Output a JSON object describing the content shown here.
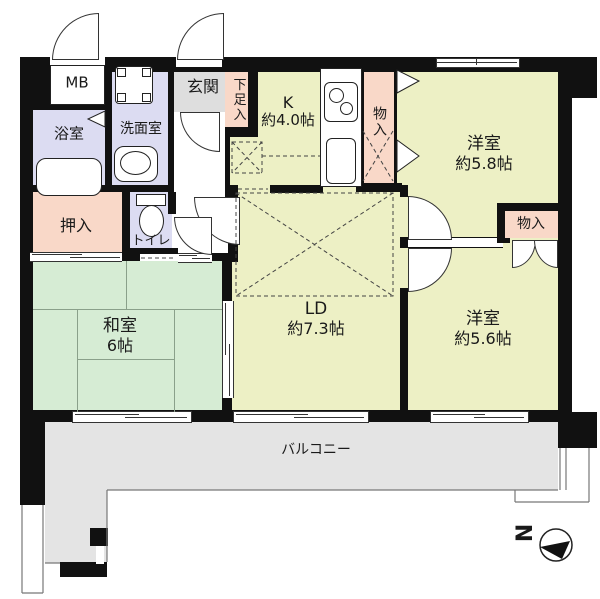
{
  "rooms": {
    "mb": {
      "label": "MB"
    },
    "bathroom": {
      "label": "浴室"
    },
    "washroom": {
      "label": "洗面室"
    },
    "entrance": {
      "label": "玄関"
    },
    "shoe_storage": {
      "label": "下足入"
    },
    "kitchen": {
      "label": "K",
      "size": "約4.0帖"
    },
    "storage_top": {
      "label": "物入"
    },
    "western_room_1": {
      "label": "洋室",
      "size": "約5.8帖"
    },
    "closet_oshiire": {
      "label": "押入"
    },
    "toilet": {
      "label": "トイレ"
    },
    "storage_right": {
      "label": "物入"
    },
    "living_dining": {
      "label": "LD",
      "size": "約7.3帖"
    },
    "japanese_room": {
      "label": "和室",
      "size": "6帖"
    },
    "western_room_2": {
      "label": "洋室",
      "size": "約5.6帖"
    },
    "balcony": {
      "label": "バルコニー"
    }
  },
  "compass": {
    "label": "N"
  },
  "colors": {
    "room_floor": "#edf0c5",
    "tatami_green": "#d6ecd4",
    "wet_area_purple": "#dcdcf2",
    "closet_pink": "#f9d8c8",
    "entrance_gray": "#dedede",
    "balcony_gray": "#e4e4e4",
    "wall": "#111111"
  }
}
